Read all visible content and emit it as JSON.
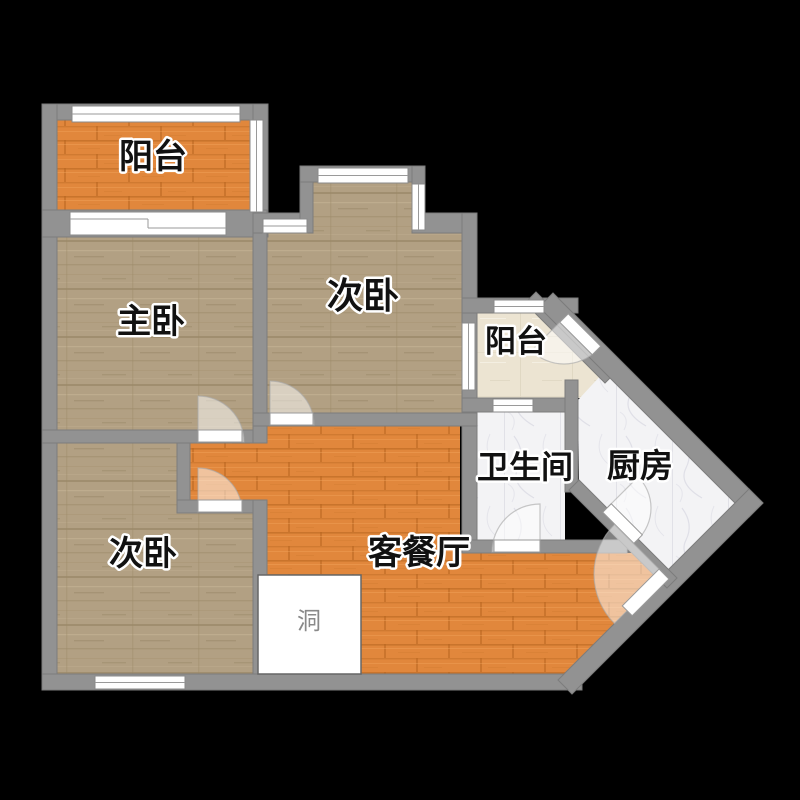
{
  "floorplan": {
    "background": "#000000",
    "colors": {
      "wall": "#929292",
      "orange_wood": "#e1873c",
      "tan_wood": "#b2a083",
      "cream_tile": "#ece4d2",
      "white_marble": "#f3f3f5",
      "hole_fill": "#ffffff"
    },
    "rooms": [
      {
        "id": "balcony-top",
        "label": "阳台",
        "floor": "orange-wood"
      },
      {
        "id": "master-bedroom",
        "label": "主卧",
        "floor": "tan-wood"
      },
      {
        "id": "second-bedroom-top",
        "label": "次卧",
        "floor": "tan-wood"
      },
      {
        "id": "balcony-right",
        "label": "阳台",
        "floor": "cream-tile"
      },
      {
        "id": "bathroom",
        "label": "卫生间",
        "floor": "white-marble"
      },
      {
        "id": "kitchen",
        "label": "厨房",
        "floor": "white-marble"
      },
      {
        "id": "second-bedroom-bottom",
        "label": "次卧",
        "floor": "tan-wood"
      },
      {
        "id": "living-dining",
        "label": "客餐厅",
        "floor": "orange-wood"
      },
      {
        "id": "hole",
        "label": "洞",
        "floor": "white"
      }
    ]
  }
}
